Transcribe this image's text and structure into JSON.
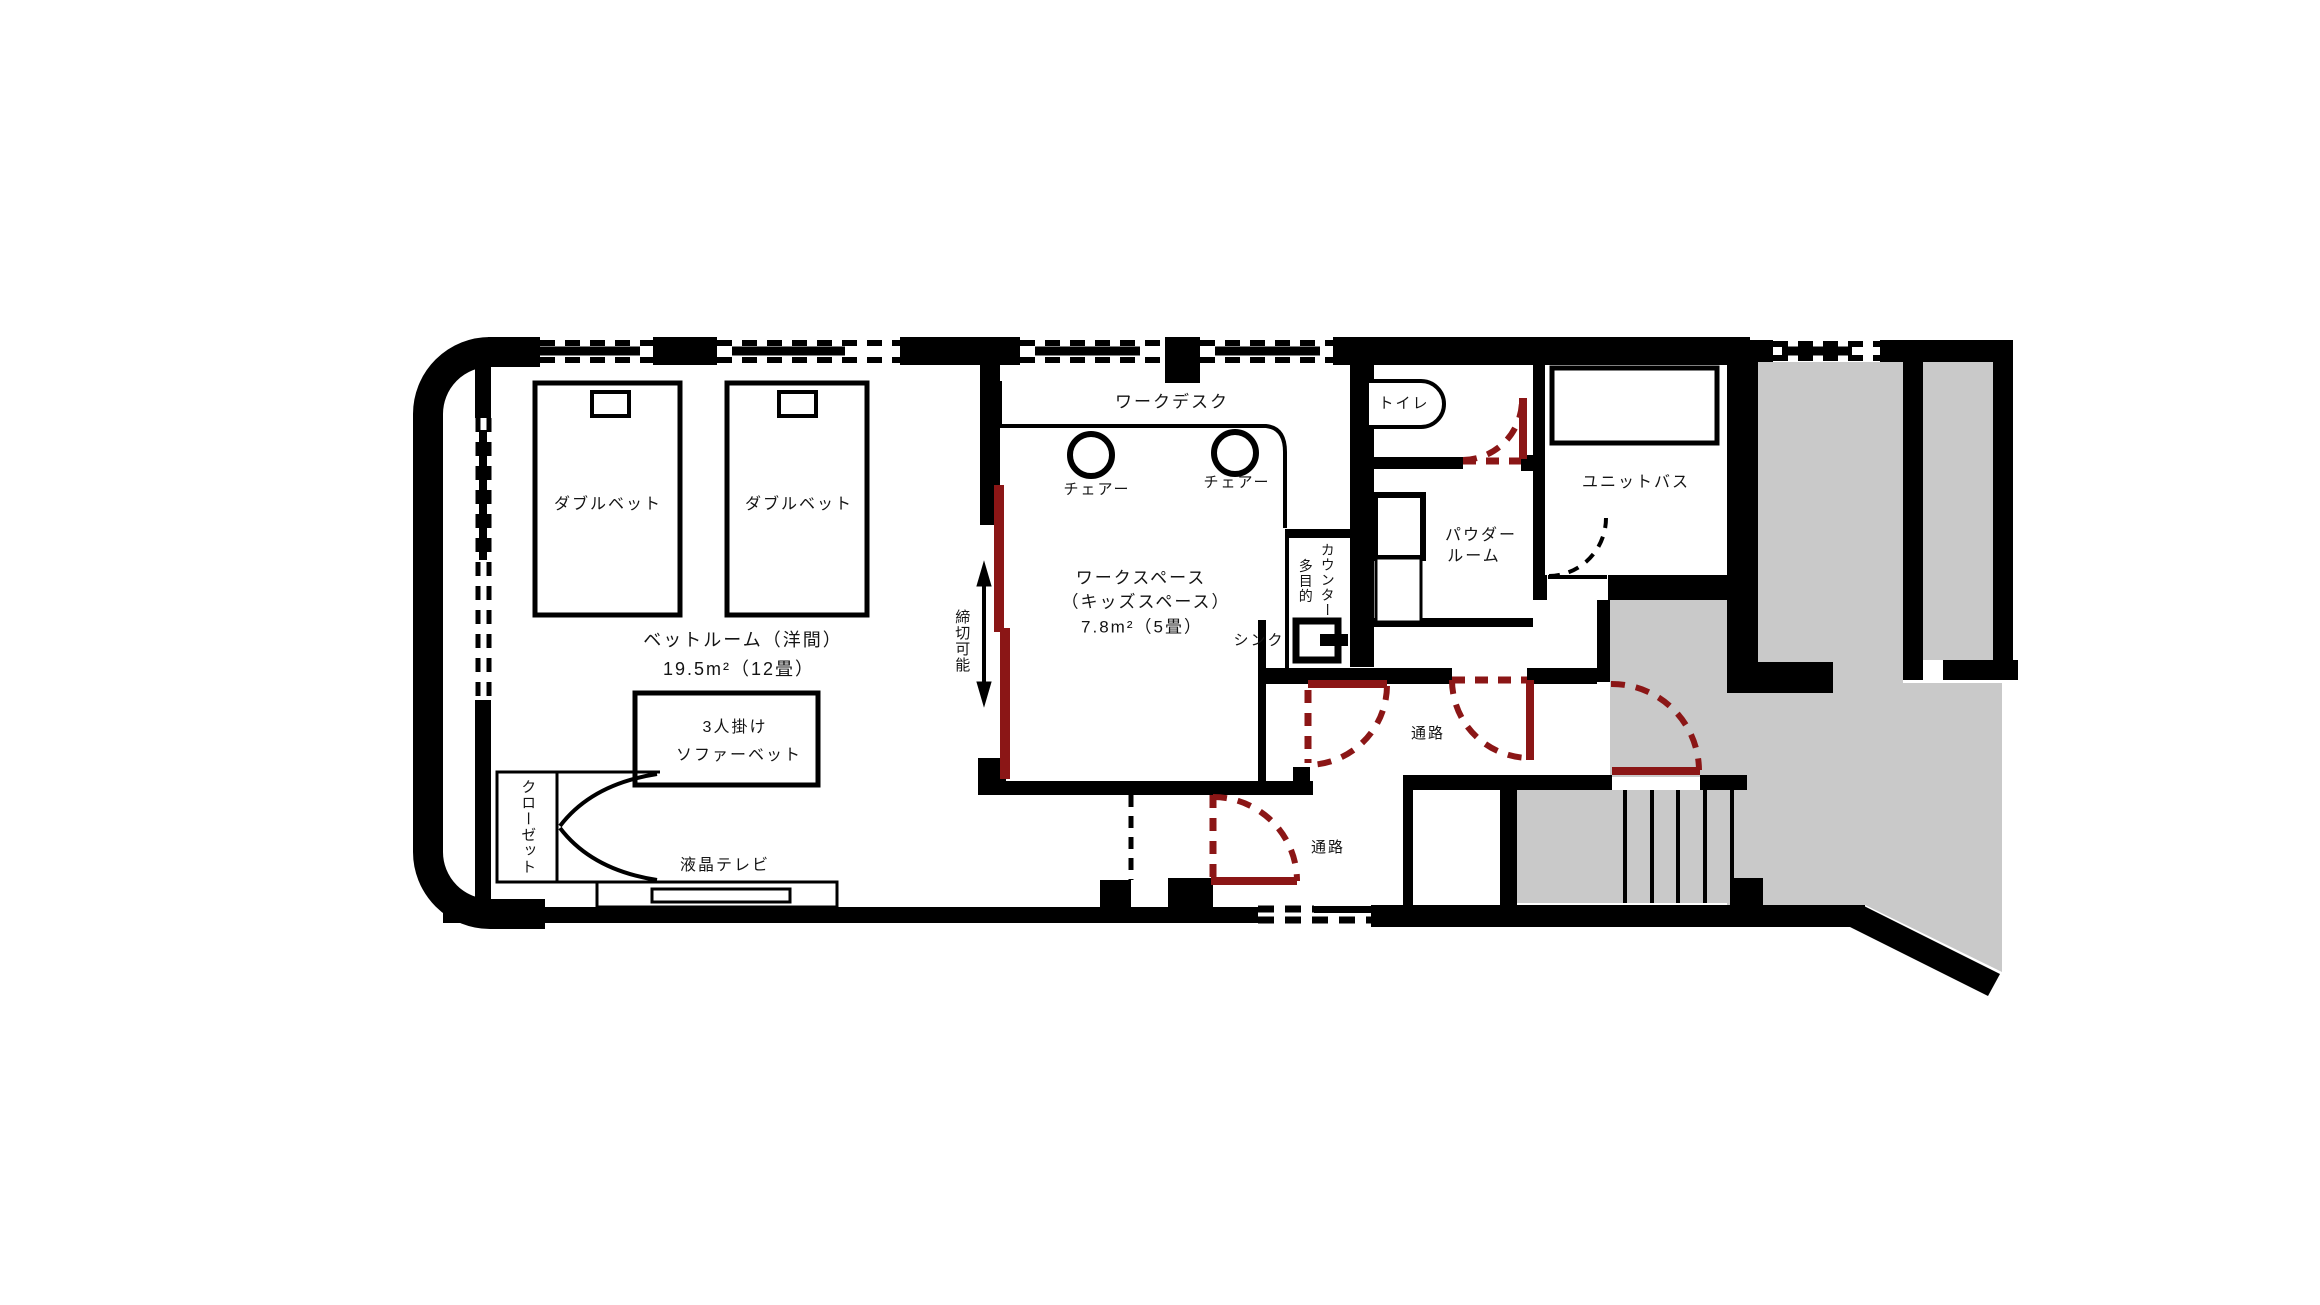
{
  "meta": {
    "type": "hotel-room-floor-plan"
  },
  "colors": {
    "wall": "#000000",
    "door_accent": "#8b1616",
    "common_area": "#c9c9c9",
    "floor": "#ffffff",
    "text": "#141414"
  },
  "rooms": {
    "bedroom": {
      "name": "ベットルーム（洋間）",
      "area": "19.5m²（12畳）"
    },
    "workspace": {
      "name": "ワークスペース",
      "alt": "（キッズスペース）",
      "area": "7.8m²（5畳）"
    },
    "toilet": {
      "name": "トイレ"
    },
    "powder_room": {
      "line1": "パウダー",
      "line2": "ルーム"
    },
    "unit_bath": {
      "name": "ユニットバス"
    },
    "corridor_upper": {
      "name": "通路"
    },
    "corridor_lower": {
      "name": "通路"
    }
  },
  "furniture": {
    "double_bed_left": "ダブルベット",
    "double_bed_right": "ダブルベット",
    "sofa_bed": {
      "line1": "3人掛け",
      "line2": "ソファーベット"
    },
    "tv": "液晶テレビ",
    "closet": "クローゼット",
    "work_desk": "ワークデスク",
    "chair_left": "チェアー",
    "chair_right": "チェアー",
    "sink": "シンク",
    "multi_counter": {
      "line1": "多目的",
      "line2": "カウンター"
    }
  },
  "annotations": {
    "partitionable": "締切可能"
  }
}
